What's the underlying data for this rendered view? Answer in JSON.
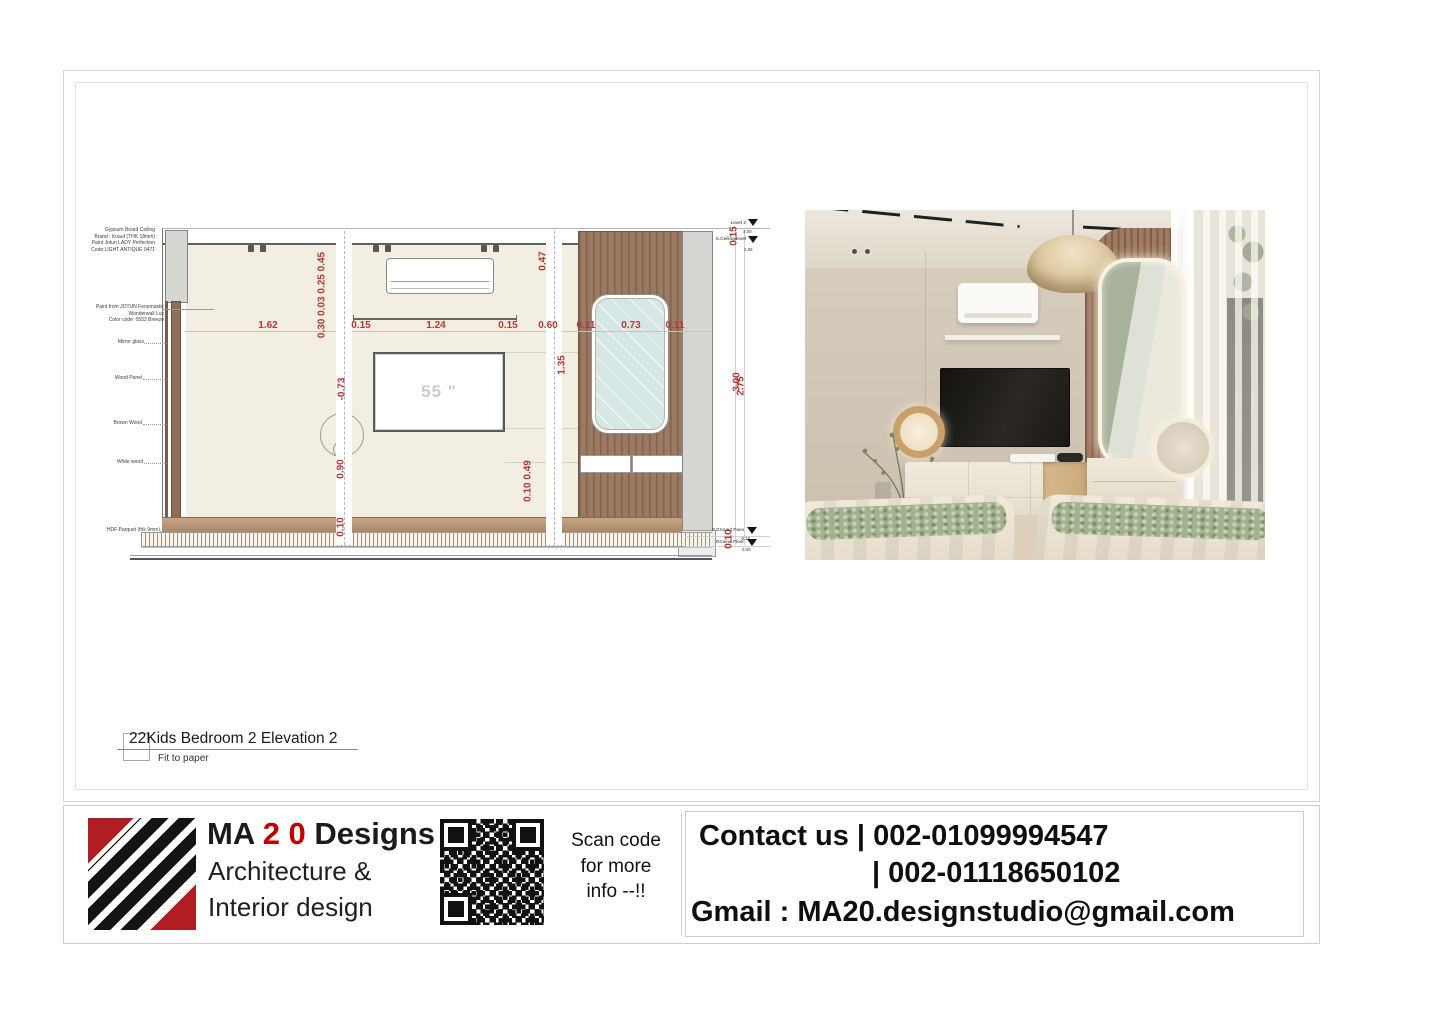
{
  "colors": {
    "dim_red": "#b13a36",
    "brand_red": "#c00000",
    "logo_red": "#b01e23",
    "wood_brown": "#9b7a64",
    "mirror_glass": "#d5e7e5",
    "wall_cream": "#f2eee1"
  },
  "sheet": {
    "title": "22Kids Bedroom 2 Elevation 2",
    "fit_label": "Fit to paper"
  },
  "elevation": {
    "tv_size": "55 \"",
    "material_labels": [
      {
        "text": "Gypsum Board Ceiling\nBrand : Knauf (THK 18mm)\nPaint Jotun LADY Perfection\nCode:LIGHT ANTIQUE 0471"
      },
      {
        "text": "Paint from JOTUN Fenomastic\nWonderwall Lux\nColor code: 0552 Breeze"
      },
      {
        "text": "Mirror glass"
      },
      {
        "text": "Wood Panel"
      },
      {
        "text": "Brown Wood"
      },
      {
        "text": "White wood"
      },
      {
        "text": "HDF Parquet (thk 9mm)"
      }
    ],
    "levels": [
      {
        "name": "Level 2",
        "value": "3.00"
      },
      {
        "name": "S.Ceiling level",
        "value": "2.85"
      },
      {
        "name": "F.Ground Face",
        "value": "-0.10"
      },
      {
        "name": "Ground Floor",
        "value": "0.00"
      }
    ],
    "h_dims": [
      {
        "text": "1.62"
      },
      {
        "text": "0.15"
      },
      {
        "text": "1.24"
      },
      {
        "text": "0.15"
      },
      {
        "text": "0.60"
      },
      {
        "text": "0.11"
      },
      {
        "text": "0.73"
      },
      {
        "text": "0.11"
      }
    ],
    "v_dims": [
      {
        "text": "0.30 0.03 0.25 0.45"
      },
      {
        "text": "0.47"
      },
      {
        "text": "-0.73"
      },
      {
        "text": "1.35"
      },
      {
        "text": "0.90"
      },
      {
        "text": "0.10 0.49"
      },
      {
        "text": "0.10"
      },
      {
        "text": "0.15"
      },
      {
        "text": "3.00"
      },
      {
        "text": "2.75"
      },
      {
        "text": "0.10"
      }
    ]
  },
  "footer": {
    "brand_prefix": "MA",
    "brand_number": "2 0",
    "brand_suffix": "Designs",
    "brand_line2": "Architecture &",
    "brand_line3": "Interior design",
    "qr_caption": "Scan code\nfor more\ninfo --!!",
    "contact": {
      "line1": "Contact us | 002-01099994547",
      "line2": "| 002-01118650102",
      "line3": "Gmail : MA20.designstudio@gmail.com"
    }
  }
}
